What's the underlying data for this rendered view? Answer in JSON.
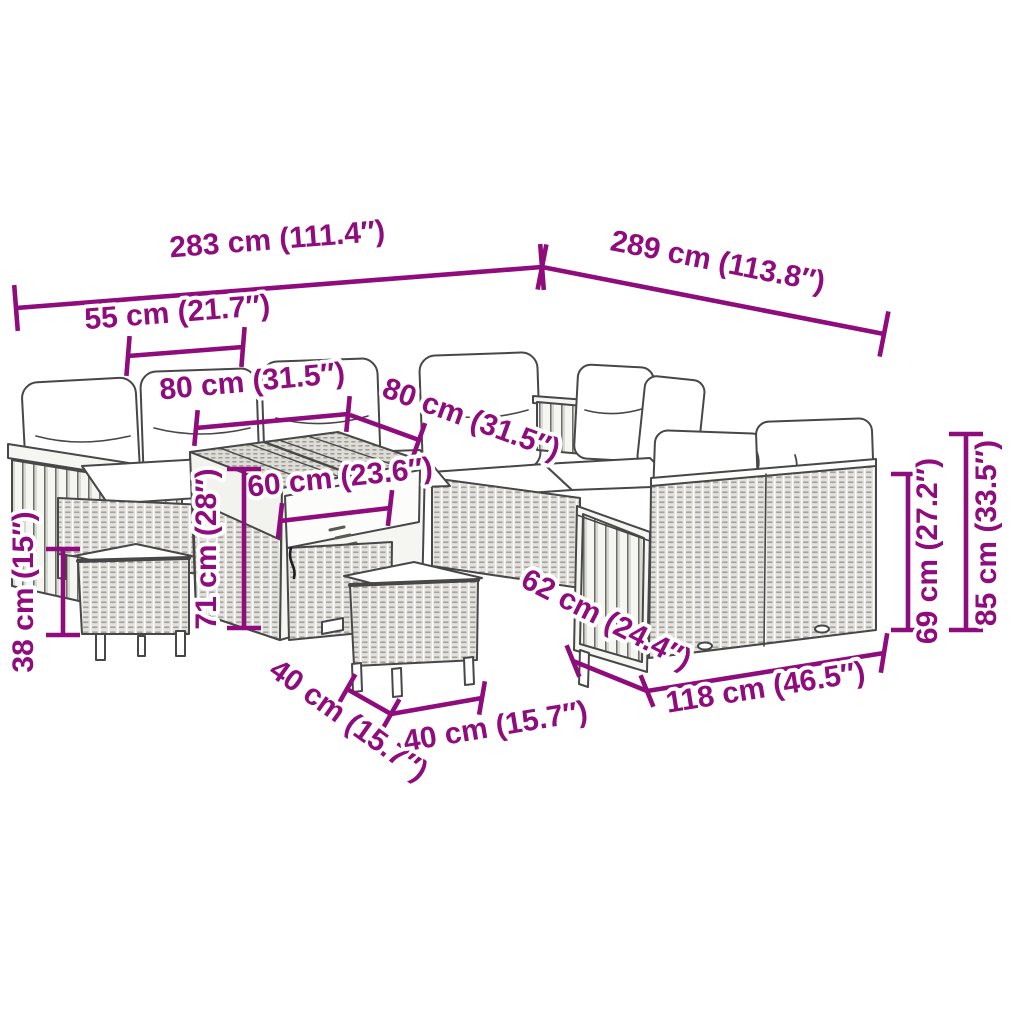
{
  "image_type": "product-dimension-diagram",
  "product": "rattan garden lounge set with table and stools",
  "colors": {
    "dimension_accent": "#8E0C7C",
    "outline": "#474747",
    "rattan_fill": "#e3e2de",
    "rattan_dash": "#a5a49c",
    "wood_fill": "#f5f5f2",
    "background": "#ffffff"
  },
  "dims": {
    "w283": {
      "label": "283 cm (111.4″)"
    },
    "w289": {
      "label": "289 cm (113.8″)"
    },
    "w55": {
      "label": "55 cm (21.7″)"
    },
    "w80a": {
      "label": "80 cm (31.5″)"
    },
    "w80b": {
      "label": "80 cm (31.5″)"
    },
    "w60": {
      "label": "60 cm (23.6″)"
    },
    "h71": {
      "label": "71 cm (28″)"
    },
    "h38": {
      "label": "38 cm (15″)"
    },
    "w40a": {
      "label": "40 cm (15.7″)"
    },
    "w40b": {
      "label": "40 cm (15.7″)"
    },
    "w62": {
      "label": "62 cm (24.4″)"
    },
    "w118": {
      "label": "118 cm (46.5″)"
    },
    "h69": {
      "label": "69 cm (27.2″)"
    },
    "h85": {
      "label": "85 cm (33.5″)"
    }
  }
}
